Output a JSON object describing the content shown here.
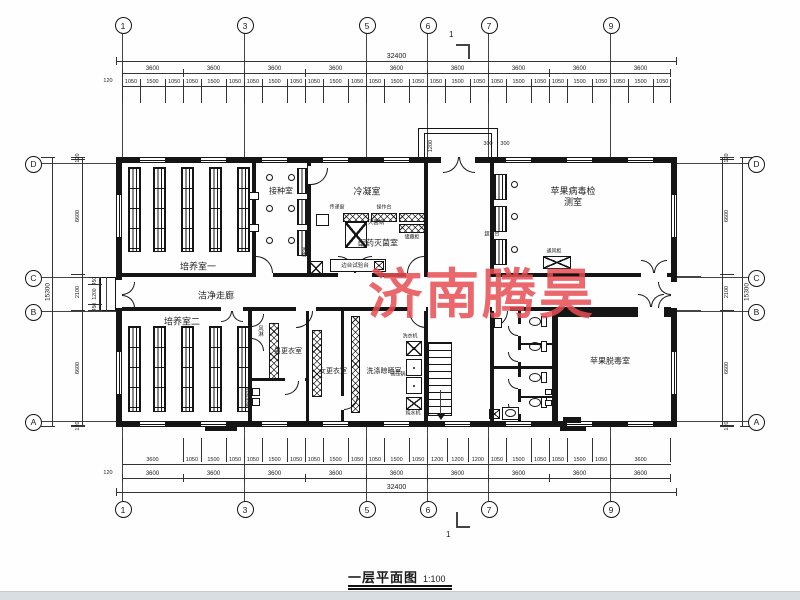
{
  "watermark": {
    "text": "济南腾昊",
    "color": "#e64c52"
  },
  "title": {
    "text": "一层平面图",
    "scale": "1:100"
  },
  "grid": {
    "top": [
      "1",
      "3",
      "5",
      "6",
      "7",
      "9"
    ],
    "bottom": [
      "1",
      "3",
      "5",
      "6",
      "7",
      "9"
    ],
    "left": [
      "D",
      "C",
      "B",
      "A"
    ],
    "right": [
      "D",
      "C",
      "B",
      "A"
    ]
  },
  "section_marks": {
    "top": "1",
    "bottom": "1"
  },
  "dimensions": {
    "top": {
      "total": "32400",
      "edge": "120",
      "bays": [
        "3600",
        "3600",
        "3600",
        "3600",
        "3600",
        "3600",
        "3600",
        "3600",
        "3600"
      ],
      "sub": [
        "1050",
        "1500",
        "1050",
        "1050",
        "1500",
        "1050",
        "1050",
        "1500",
        "1050",
        "1050",
        "1500",
        "1050",
        "1050",
        "1500",
        "1050",
        "1050",
        "1500",
        "1050",
        "1050",
        "1500",
        "1050",
        "1050",
        "1500",
        "1050",
        "1050",
        "1500",
        "1050"
      ]
    },
    "bottom": {
      "total": "32400",
      "edge": "120",
      "bays": [
        "3600",
        "3600",
        "3600",
        "3600",
        "3600",
        "3600",
        "3600",
        "3600",
        "3600"
      ],
      "sub": [
        "3600",
        "1050",
        "1500",
        "1050",
        "1050",
        "1500",
        "1050",
        "1050",
        "1500",
        "1050",
        "1050",
        "1500",
        "1050",
        "1200",
        "1200",
        "1200",
        "1050",
        "1500",
        "1050",
        "1050",
        "1500",
        "1050",
        "3600"
      ]
    },
    "left": {
      "total": "15300",
      "segs": [
        "120",
        "6600",
        "2100",
        "6600",
        "120"
      ],
      "sub": [
        "450",
        "1200",
        "450"
      ]
    },
    "right": {
      "total": "15300",
      "segs": [
        "120",
        "6600",
        "2100",
        "6600",
        "120"
      ]
    },
    "entrance": [
      "1200",
      "300",
      "300"
    ]
  },
  "rooms": [
    {
      "id": "culture1",
      "label": "培养室一"
    },
    {
      "id": "inoculation",
      "label": "接种室"
    },
    {
      "id": "condensing",
      "label": "冷凝室"
    },
    {
      "id": "prep",
      "label": "配药灭菌室"
    },
    {
      "id": "virus-test",
      "label": "苹果病毒检测室"
    },
    {
      "id": "corridor",
      "label": "洁净走廊"
    },
    {
      "id": "culture2",
      "label": "培养室二"
    },
    {
      "id": "air-shower",
      "label": "风淋"
    },
    {
      "id": "men-change",
      "label": "男更衣室"
    },
    {
      "id": "women-change",
      "label": "女更衣室"
    },
    {
      "id": "wash-dry",
      "label": "洗涤晾晒室"
    },
    {
      "id": "virus-free",
      "label": "苹果脱毒室"
    }
  ],
  "equipment": [
    {
      "id": "pass-window",
      "label": "传递窗"
    },
    {
      "id": "sterilizer",
      "label": "灭菌锅"
    },
    {
      "id": "bench-top",
      "label": "操作台"
    },
    {
      "id": "storage-cabinet",
      "label": "储藏柜"
    },
    {
      "id": "side-bench",
      "label": "边台试验台"
    },
    {
      "id": "sink",
      "label": "洗槽"
    },
    {
      "id": "clean-bench",
      "label": "超净台"
    },
    {
      "id": "fume-hood",
      "label": "通风柜"
    },
    {
      "id": "washer",
      "label": "洗衣机"
    },
    {
      "id": "autoclave",
      "label": "高压锅"
    },
    {
      "id": "water-purifier",
      "label": "纯水机"
    },
    {
      "id": "hand-sanitizer",
      "label": "手消毒器"
    }
  ]
}
